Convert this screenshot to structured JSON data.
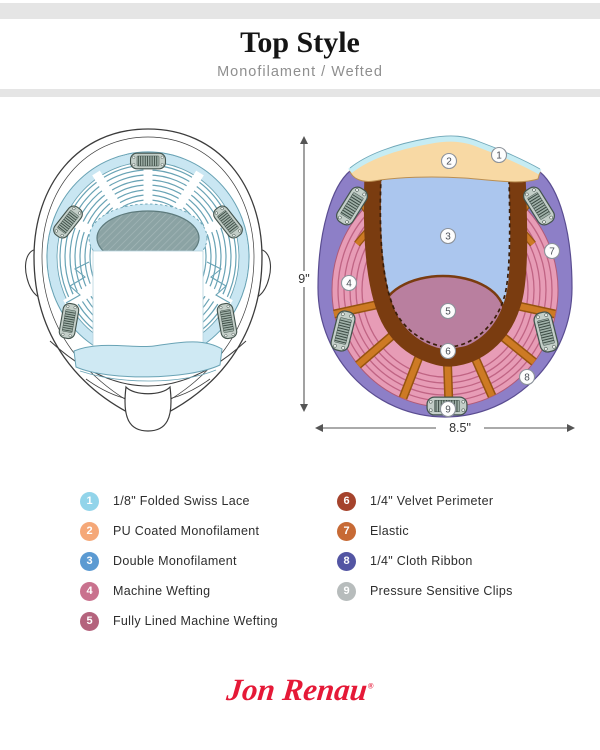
{
  "header": {
    "title": "Top Style",
    "subtitle": "Monofilament / Wefted"
  },
  "diagram": {
    "dimensions": {
      "height_label": "9\"",
      "width_label": "8.5\""
    },
    "callouts": [
      "1",
      "2",
      "3",
      "4",
      "5",
      "6",
      "7",
      "8",
      "9"
    ],
    "colors": {
      "swiss_lace": "#c6ecf3",
      "pu_coated_monofilament": "#f8d9a4",
      "double_monofilament": "#abc6ee",
      "machine_wefting": "#e79cb6",
      "fully_lined_machine_wefting": "#b97f9f",
      "velvet_perimeter": "#7a3c10",
      "elastic": "#cd7a24",
      "cloth_ribbon": "#8d7fc7",
      "pressure_sensitive_clips": "#c3cec8"
    }
  },
  "legend": {
    "left": [
      {
        "num": "1",
        "label": "1/8\" Folded Swiss Lace",
        "color": "#92d4ea"
      },
      {
        "num": "2",
        "label": "PU Coated Monofilament",
        "color": "#f5a878"
      },
      {
        "num": "3",
        "label": "Double Monofilament",
        "color": "#5b9ad2"
      },
      {
        "num": "4",
        "label": "Machine Wefting",
        "color": "#c9728e"
      },
      {
        "num": "5",
        "label": "Fully Lined Machine Wefting",
        "color": "#b4637d"
      }
    ],
    "right": [
      {
        "num": "6",
        "label": "1/4\" Velvet Perimeter",
        "color": "#a5432c"
      },
      {
        "num": "7",
        "label": "Elastic",
        "color": "#c76a35"
      },
      {
        "num": "8",
        "label": "1/4\" Cloth Ribbon",
        "color": "#5355a3"
      },
      {
        "num": "9",
        "label": "Pressure Sensitive Clips",
        "color": "#b7bcbc"
      }
    ]
  },
  "logo": {
    "text": "Jon Renau",
    "registered": "®"
  }
}
